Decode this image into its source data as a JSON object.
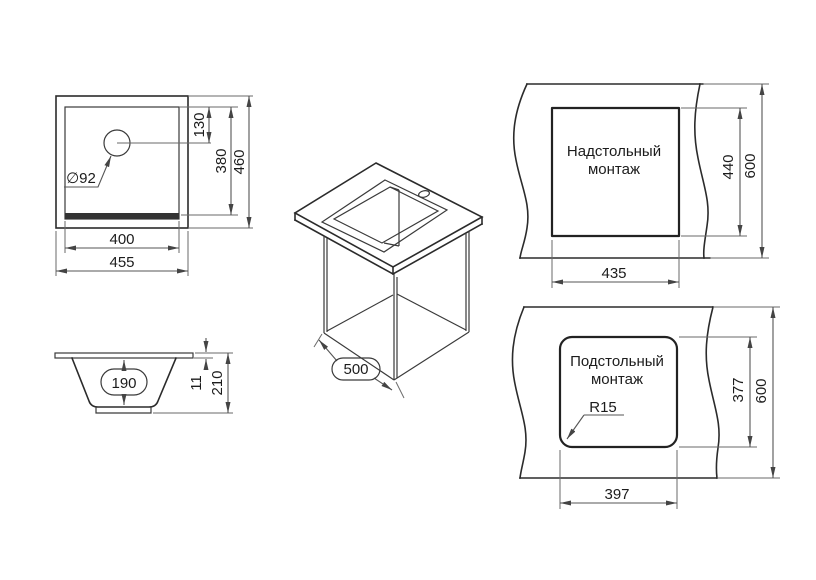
{
  "drawing": {
    "background": "#ffffff",
    "line_color": "#2b2b2b",
    "dimension_color": "#555555",
    "top_view": {
      "hole_diameter": "∅92",
      "hole_offset": "130",
      "inner_height": "380",
      "outer_height": "460",
      "inner_width": "400",
      "outer_width": "455"
    },
    "side_view": {
      "bowl_depth": "190",
      "rim_thickness": "11",
      "total_height": "210"
    },
    "isometric_view": {
      "cabinet_depth": "500"
    },
    "overmount_view": {
      "title_line1": "Надстольный",
      "title_line2": "монтаж",
      "cutout_width": "435",
      "cutout_height": "440",
      "counter_depth": "600"
    },
    "undermount_view": {
      "title_line1": "Подстольный",
      "title_line2": "монтаж",
      "cutout_width": "397",
      "cutout_height": "377",
      "counter_depth": "600",
      "corner_radius": "R15"
    }
  }
}
